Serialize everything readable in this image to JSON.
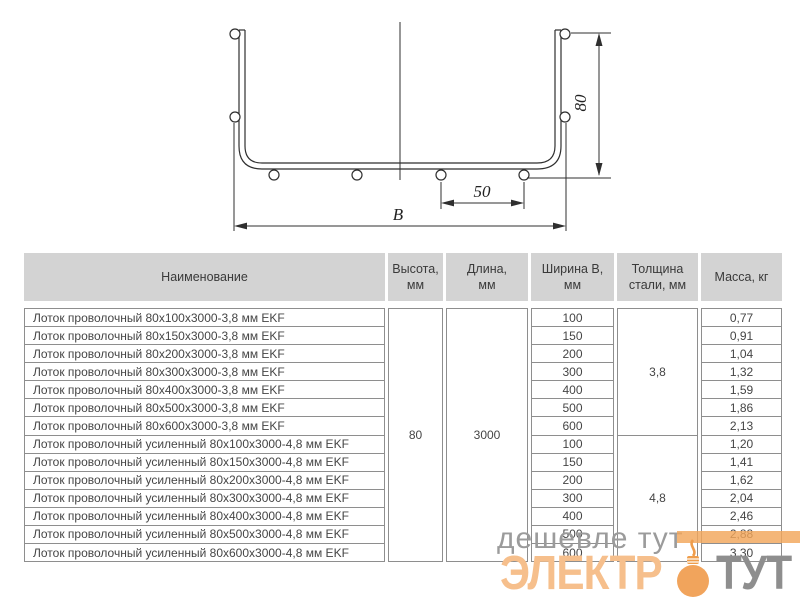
{
  "diagram": {
    "height_dim": "80",
    "pitch_dim": "50",
    "width_dim": "B"
  },
  "table": {
    "columns": {
      "name": "Наименование",
      "height": "Высота,\nмм",
      "length": "Длина,\nмм",
      "width": "Ширина В,\nмм",
      "thickness": "Толщина\nстали, мм",
      "mass": "Масса, кг"
    },
    "height_value": "80",
    "length_value": "3000",
    "groups": [
      {
        "thickness": "3,8",
        "rows": [
          {
            "name": "Лоток проволочный 80х100х3000-3,8 мм EKF",
            "width": "100",
            "mass": "0,77"
          },
          {
            "name": "Лоток проволочный 80х150х3000-3,8 мм EKF",
            "width": "150",
            "mass": "0,91"
          },
          {
            "name": "Лоток проволочный 80х200х3000-3,8 мм EKF",
            "width": "200",
            "mass": "1,04"
          },
          {
            "name": "Лоток проволочный 80х300х3000-3,8 мм EKF",
            "width": "300",
            "mass": "1,32"
          },
          {
            "name": "Лоток проволочный 80х400х3000-3,8 мм EKF",
            "width": "400",
            "mass": "1,59"
          },
          {
            "name": "Лоток проволочный 80х500х3000-3,8 мм EKF",
            "width": "500",
            "mass": "1,86"
          },
          {
            "name": "Лоток проволочный 80х600х3000-3,8 мм EKF",
            "width": "600",
            "mass": "2,13"
          }
        ]
      },
      {
        "thickness": "4,8",
        "rows": [
          {
            "name": "Лоток проволочный усиленный 80х100х3000-4,8 мм EKF",
            "width": "100",
            "mass": "1,20"
          },
          {
            "name": "Лоток проволочный усиленный 80х150х3000-4,8 мм EKF",
            "width": "150",
            "mass": "1,41"
          },
          {
            "name": "Лоток проволочный усиленный 80х200х3000-4,8 мм EKF",
            "width": "200",
            "mass": "1,62"
          },
          {
            "name": "Лоток проволочный усиленный 80х300х3000-4,8 мм EKF",
            "width": "300",
            "mass": "2,04"
          },
          {
            "name": "Лоток проволочный усиленный 80х400х3000-4,8 мм EKF",
            "width": "400",
            "mass": "2,46"
          },
          {
            "name": "Лоток проволочный усиленный 80х500х3000-4,8 мм EKF",
            "width": "500",
            "mass": "2,88"
          },
          {
            "name": "Лоток проволочный усиленный 80х600х3000-4,8 мм EKF",
            "width": "600",
            "mass": "3,30"
          }
        ]
      }
    ]
  },
  "watermark": {
    "slogan": "дешевле тут",
    "brand_prefix": "ЭЛЕКТР",
    "brand_suffix": "ТУТ",
    "accent_color": "#f0a155",
    "letter_color": "#f6bf8c",
    "gray_color": "#8e8e8e"
  }
}
